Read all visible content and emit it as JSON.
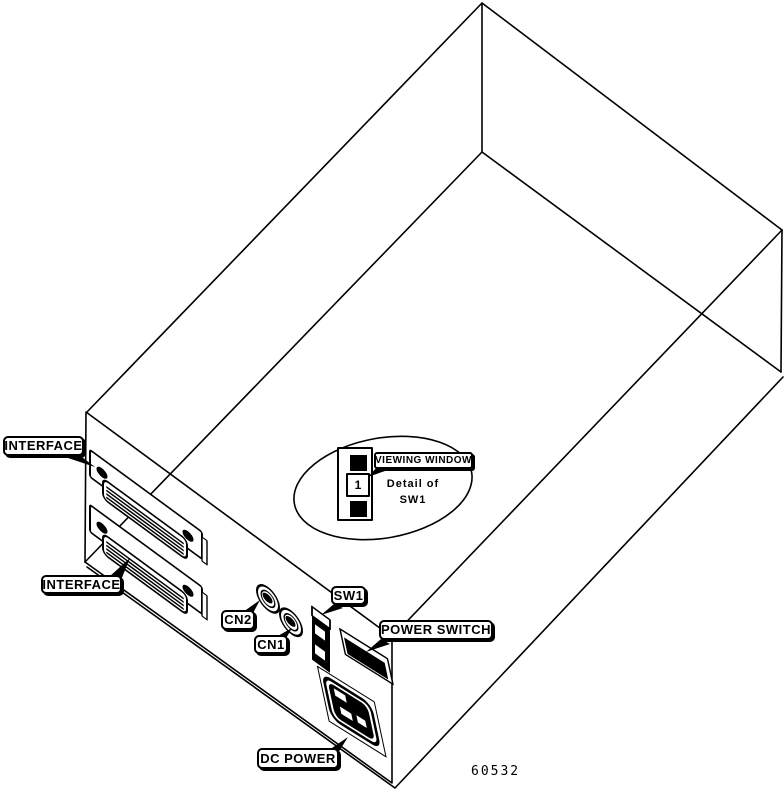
{
  "illustration": {
    "figure_number": "60532",
    "background_color": "#ffffff",
    "line_color": "#000000",
    "description": "Isometric rear view of drive enclosure showing rear-panel connectors"
  },
  "labels": {
    "interface_top": "INTERFACE",
    "interface_bottom": "INTERFACE",
    "cn2": "CN2",
    "cn1": "CN1",
    "sw1": "SW1",
    "power_switch": "POWER SWITCH",
    "viewing_window": "VIEWING WINDOW",
    "dc_power": "DC POWER"
  },
  "detail": {
    "caption_line1": "Detail of",
    "caption_line2": "SW1",
    "window_value": "1"
  }
}
